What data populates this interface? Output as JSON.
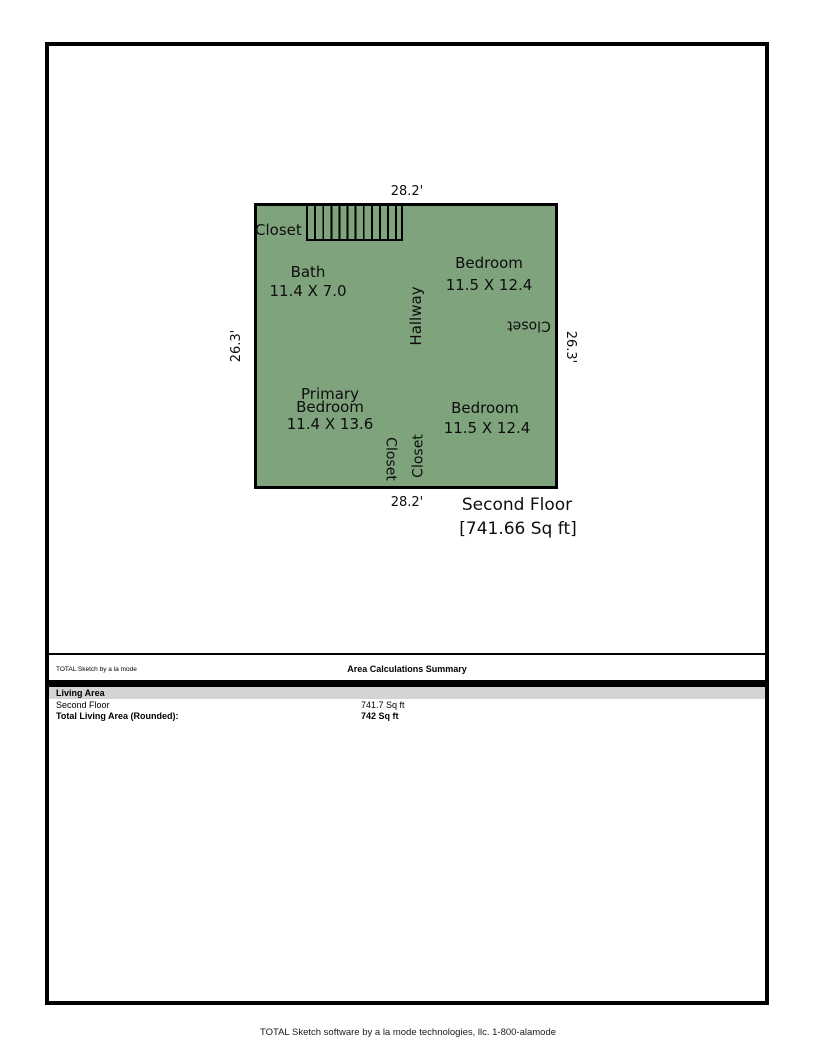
{
  "floor_plan": {
    "fill_color": "#7fa37d",
    "dimensions": {
      "top": "28.2'",
      "bottom": "28.2'",
      "left": "26.3'",
      "right": "26.3'"
    },
    "rooms": {
      "closet_top": "Closet",
      "bath": {
        "name": "Bath",
        "size": "11.4 X 7.0"
      },
      "hallway": "Hallway",
      "bedroom_top": {
        "name": "Bedroom",
        "size": "11.5 X 12.4"
      },
      "closet_right": "Closet",
      "primary_bedroom": {
        "name_line1": "Primary",
        "name_line2": "Bedroom",
        "size": "11.4 X 13.6"
      },
      "bedroom_bottom": {
        "name": "Bedroom",
        "size": "11.5 X 12.4"
      },
      "closet_middle_left": "Closet",
      "closet_middle_right": "Closet"
    },
    "floor_label": {
      "name": "Second Floor",
      "area": "[741.66 Sq ft]"
    }
  },
  "summary": {
    "brand": "TOTAL Sketch by a la mode",
    "title": "Area Calculations Summary",
    "section_header": "Living Area",
    "rows": [
      {
        "label": "Second Floor",
        "value": "741.7 Sq ft"
      },
      {
        "label": "Total Living Area (Rounded):",
        "value": "742 Sq ft"
      }
    ]
  },
  "footer": "TOTAL Sketch software by a la mode technologies, llc. 1-800-alamode"
}
